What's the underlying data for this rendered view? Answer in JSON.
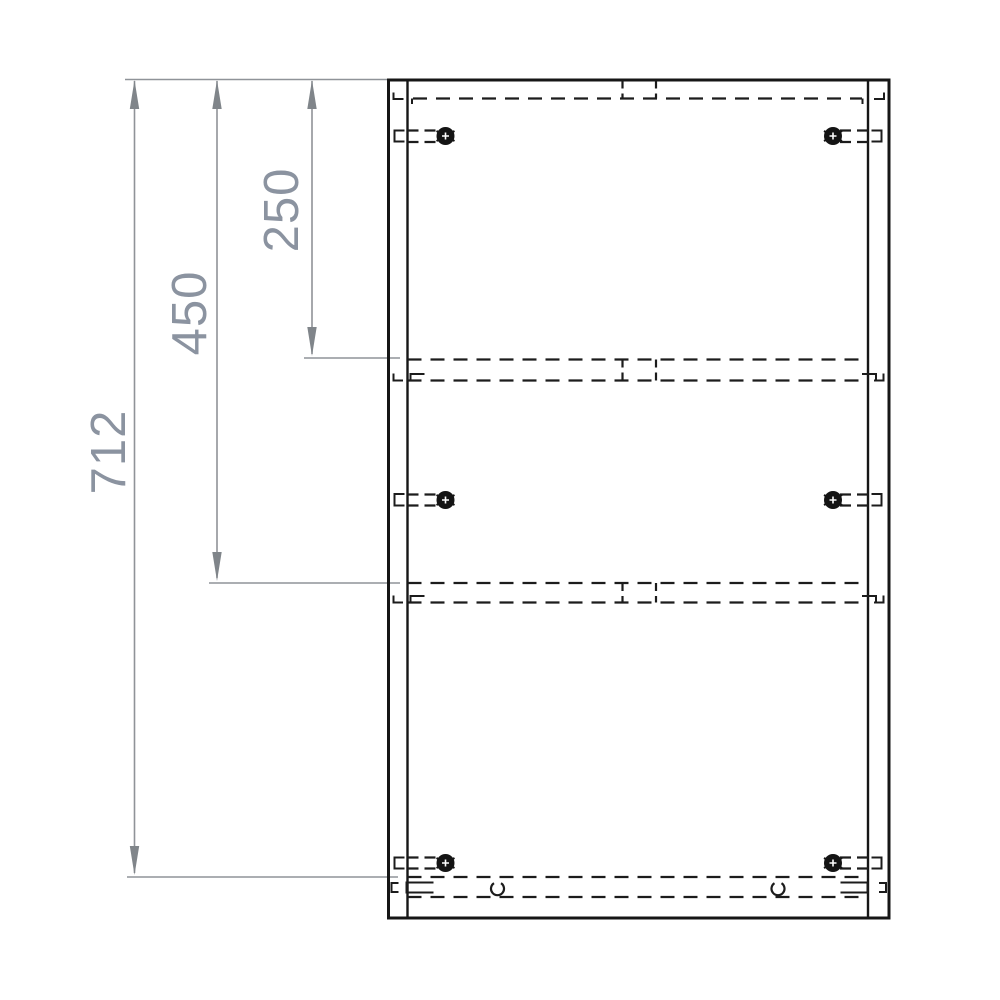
{
  "drawing": {
    "kind": "furniture-panel-technical-drawing",
    "dimensions": [
      {
        "name": "overall-height",
        "label": "712",
        "unit": "mm"
      },
      {
        "name": "middle-shelf-position",
        "label": "450",
        "unit": "mm"
      },
      {
        "name": "top-shelf-position",
        "label": "250",
        "unit": "mm"
      }
    ],
    "hardware": {
      "cam_fitting_count": 6,
      "dowel_mark_count": 2,
      "hidden_shelf_lines": 2
    },
    "colors": {
      "solid_line": "#161616",
      "dashed_line": "#1c1c1c",
      "dimension_line": "#8f9398",
      "dimension_arrow": "#80858a",
      "dimension_text": "#8b93a0",
      "background": "#ffffff"
    }
  }
}
